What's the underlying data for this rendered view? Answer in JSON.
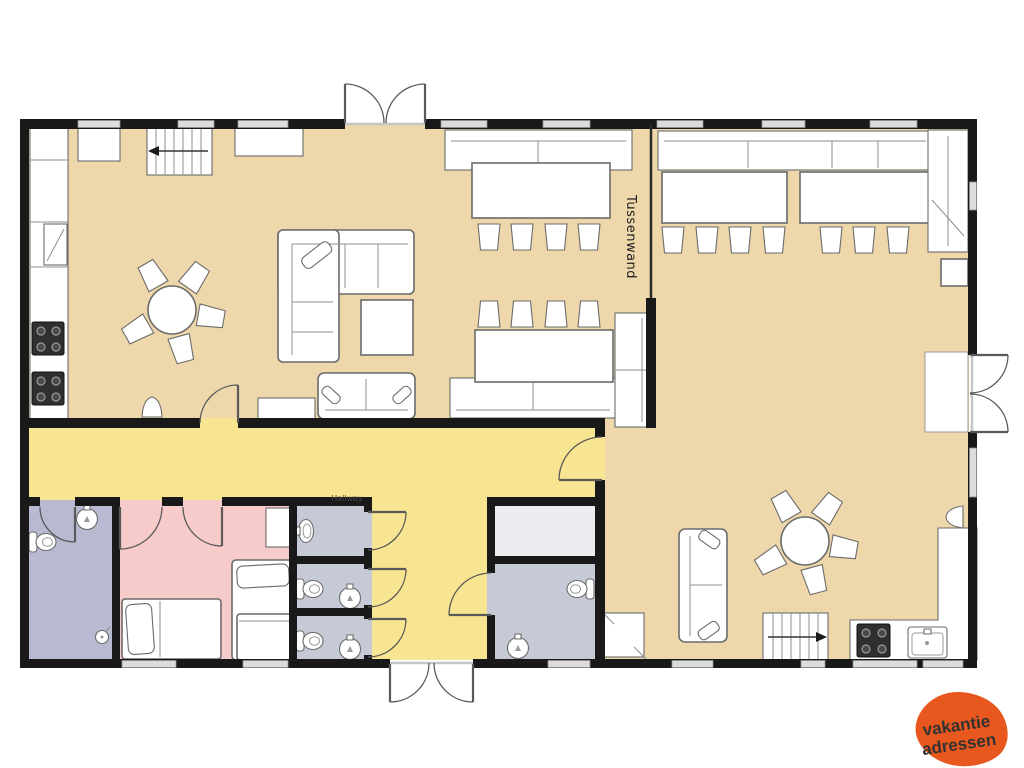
{
  "canvas": {
    "width": 1024,
    "height": 768,
    "background": "#ffffff"
  },
  "labels": {
    "tussenwand": "Tussenwand",
    "hallway": "Hallway"
  },
  "logo": {
    "line1": "vakantie",
    "line2": "adressen",
    "background_color": "#e8571d",
    "text_color": "#ffffff"
  },
  "colors": {
    "wall": "#191919",
    "living_room": "#edd7ab",
    "hallway": "#f8e591",
    "bedroom": "#f7cbca",
    "bathroom_left": "#b7bad1",
    "toilet_stalls": "#c6c9d6",
    "storage_room": "#ebebf0",
    "bathroom_middle": "#c6c9d6",
    "window": "#dcdcdc",
    "furniture_fill": "#ffffff",
    "furniture_outline": "#6b6b6b"
  },
  "symbols": {
    "chair": "trapezoid",
    "toilet": "tank-plus-bowl",
    "sink": "circle-with-tap",
    "stove": "square-with-4-burners",
    "stairs": "treads-with-direction-arrow",
    "door": "quarter-circle-swing",
    "window": "gray-band-in-wall"
  }
}
